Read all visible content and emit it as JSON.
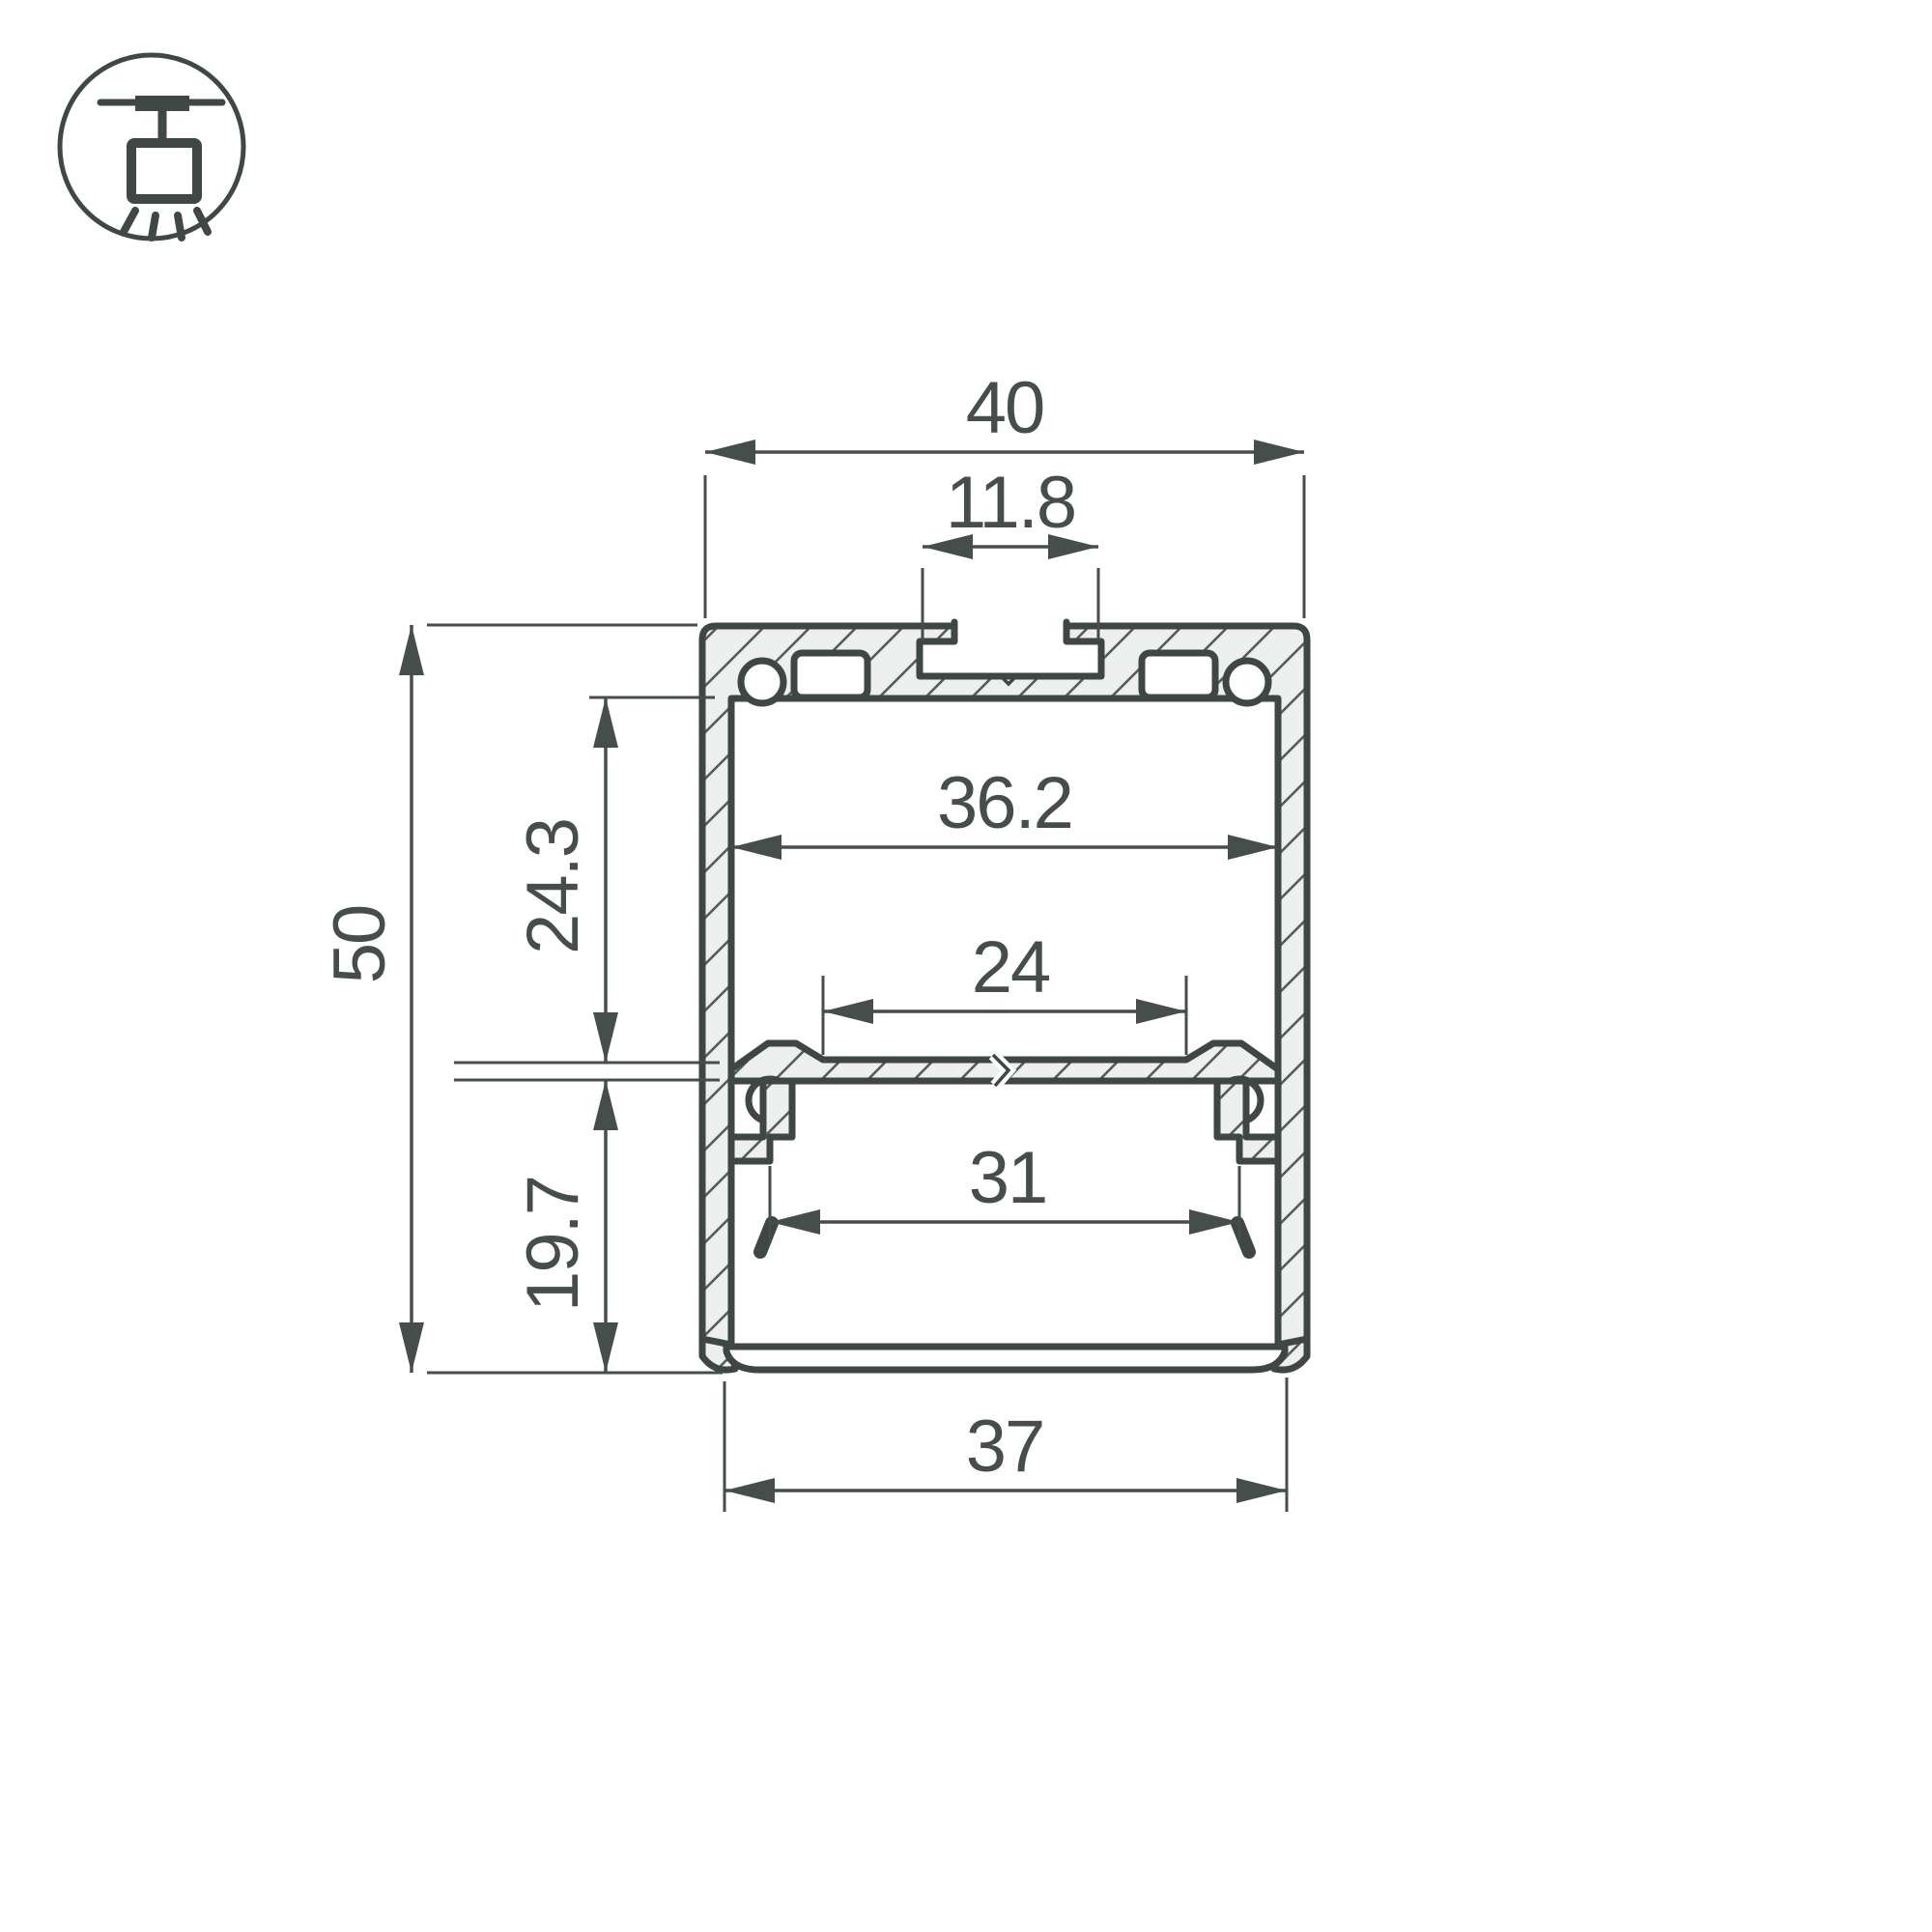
{
  "colors": {
    "background": "#ffffff",
    "line_stroke": "#3e4744",
    "dimension_stroke": "#454e4b",
    "text": "#454e4b",
    "aluminum_fill": "#edefee",
    "hatch_line": "#555e5a"
  },
  "icon": {
    "name": "ceiling-pendant-mount"
  },
  "dims": {
    "overall_width": "40",
    "top_slot_width": "11.8",
    "inner_width": "36.2",
    "upper_cavity_height": "24.3",
    "mid_recess_width": "24",
    "overall_height": "50",
    "lower_cavity_height": "19.7",
    "led_seat_width": "31",
    "diffuser_width": "37"
  }
}
